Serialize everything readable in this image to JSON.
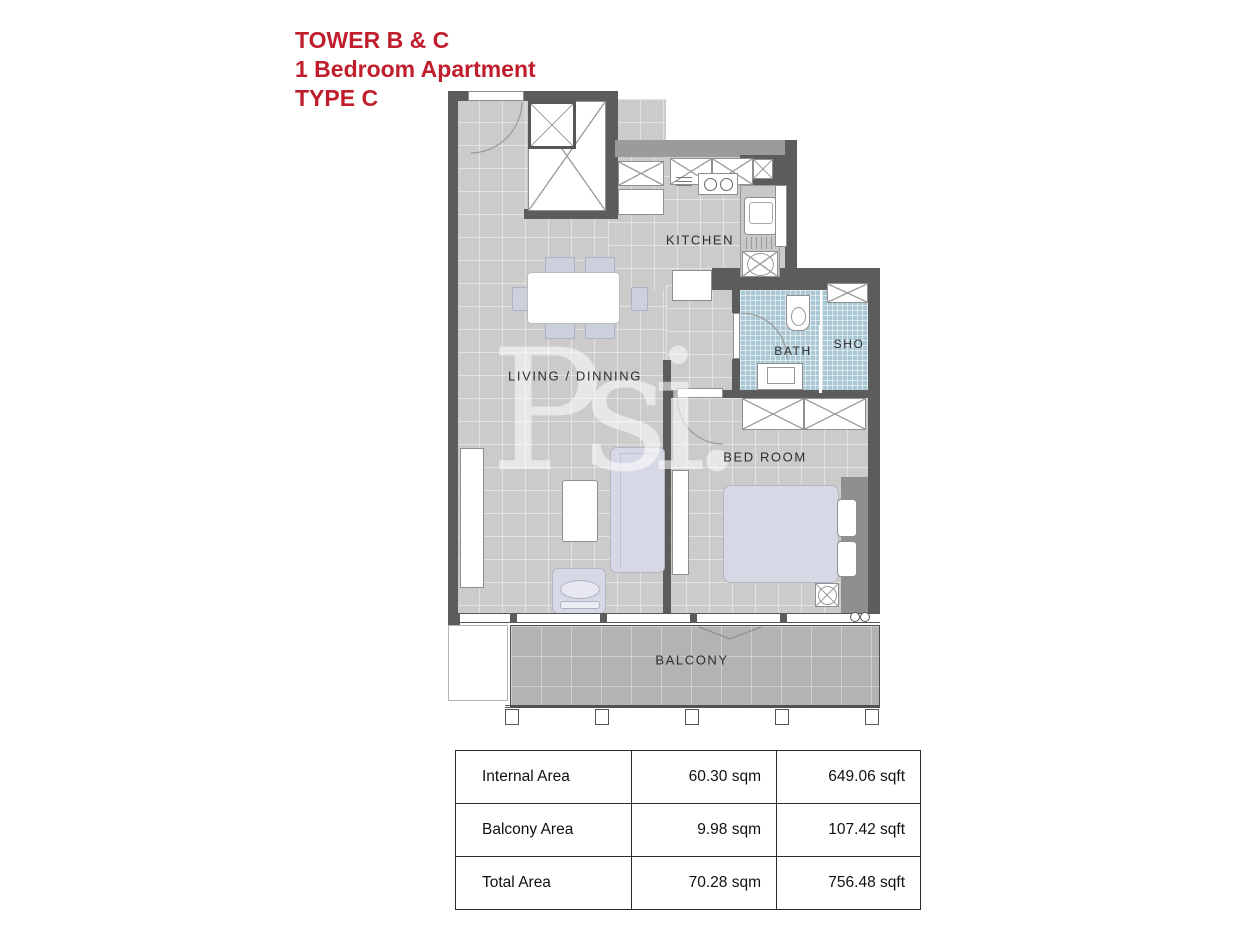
{
  "title": {
    "line1": "TOWER B & C",
    "line2": "1 Bedroom Apartment",
    "line3": "TYPE C",
    "color": "#c01e2d"
  },
  "floor_plan": {
    "labels": {
      "kitchen": "KITCHEN",
      "bath": "BATH",
      "shower": "SHO",
      "living_dining": "LIVING / DINNING",
      "bedroom": "BED ROOM",
      "balcony": "BALCONY"
    },
    "watermark": "Psi.",
    "colors": {
      "wall": "#5c5c5c",
      "floor_tile": "#cccbc9",
      "balcony_tile": "#b4b3b1",
      "bath_tile": "#aac7d4",
      "furniture_fill": "#d7d8e5",
      "furniture_white": "#ffffff"
    }
  },
  "area_table": {
    "rows": [
      {
        "label": "Internal Area",
        "sqm": "60.30 sqm",
        "sqft": "649.06 sqft"
      },
      {
        "label": "Balcony Area",
        "sqm": "9.98 sqm",
        "sqft": "107.42 sqft"
      },
      {
        "label": "Total Area",
        "sqm": "70.28 sqm",
        "sqft": "756.48 sqft"
      }
    ]
  }
}
